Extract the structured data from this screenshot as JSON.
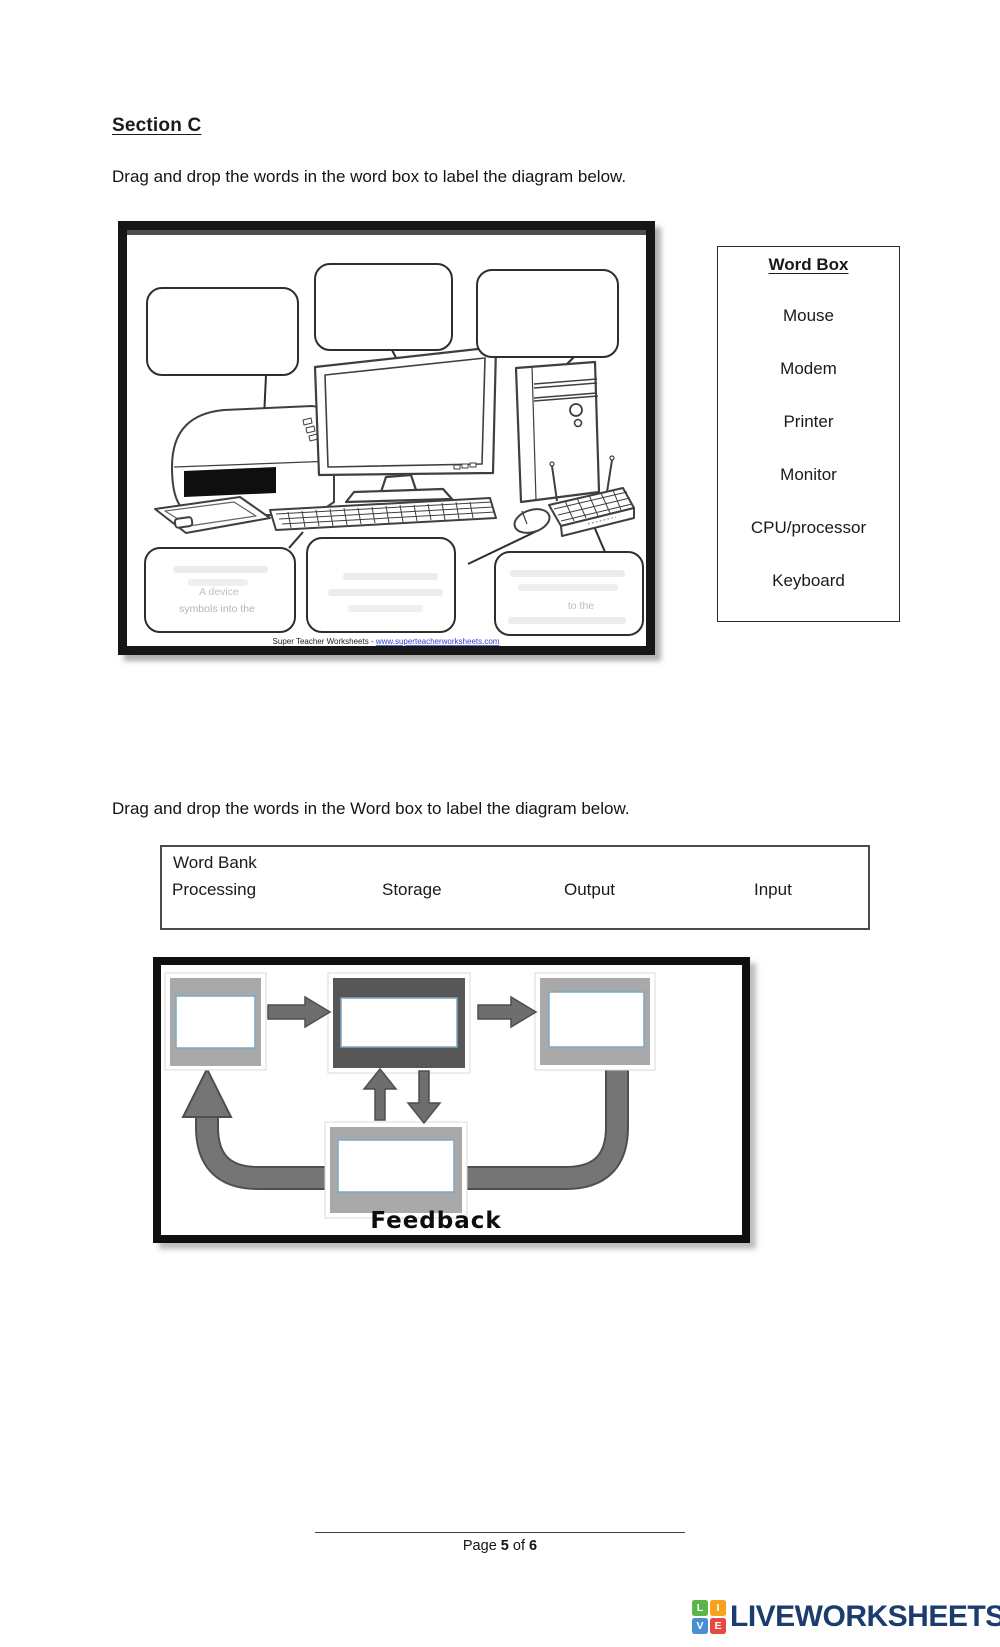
{
  "page": {
    "section_title": "Section C",
    "instruction_1": "Drag and drop the words in the word box to label the diagram below.",
    "instruction_2": "Drag and drop the words in the Word box to label the diagram below.",
    "footer": {
      "page_label": "Page ",
      "page_number": "5",
      "of_label": " of ",
      "total_pages": "6"
    }
  },
  "word_box": {
    "title": "Word Box",
    "words": [
      "Mouse",
      "Modem",
      "Printer",
      "Monitor",
      "CPU/processor",
      "Keyboard"
    ]
  },
  "word_bank": {
    "title": "Word Bank",
    "words": [
      "Processing",
      "Storage",
      "Output",
      "Input"
    ]
  },
  "diagram1": {
    "attribution_prefix": "Super Teacher Worksheets - ",
    "attribution_link": "www.superteacherworksheets.com",
    "faint_text": {
      "bottom_left_line1": "A device",
      "bottom_left_line2": "symbols into the",
      "bottom_right_line1": "to the"
    }
  },
  "diagram2": {
    "feedback_label": "Feedback"
  },
  "brand": {
    "name": "LIVEWORKSHEETS",
    "text_color": "#1c3c6e",
    "tiles": [
      {
        "letter": "L",
        "color": "#5cb548"
      },
      {
        "letter": "I",
        "color": "#f6a21d"
      },
      {
        "letter": "V",
        "color": "#4a8fd3"
      },
      {
        "letter": "E",
        "color": "#e8483f"
      }
    ]
  },
  "colors": {
    "flow_card_gray": "#a9a9a9",
    "flow_card_dark": "#575757",
    "flow_arrow": "#6e6e6e",
    "flow_arrow_edge": "#4f4f4f",
    "inner_box_border": "#7da7c4",
    "link_blue": "#3a45c4"
  }
}
